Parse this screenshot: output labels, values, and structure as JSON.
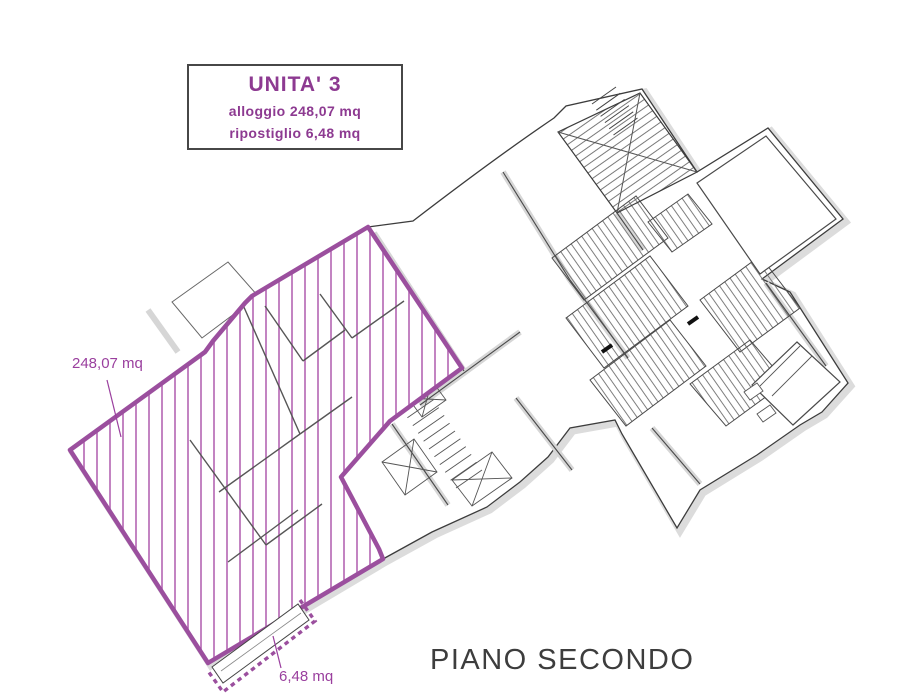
{
  "title_box": {
    "title": "UNITA' 3",
    "alloggio_line": "alloggio 248,07 mq",
    "ripostiglio_line": "ripostiglio 6,48 mq"
  },
  "annotations": {
    "alloggio_label": "248,07 mq",
    "ripostiglio_label": "6,48 mq"
  },
  "floor_title": "PIANO SECONDO",
  "colors": {
    "unit_boundary": "#9b4f9e",
    "unit_hatch": "#b466b2",
    "annotation_text": "#9a3f9e",
    "title_text": "#8d3a91",
    "building_wall": "#d9d9d9",
    "building_line": "#3c3c3c",
    "floor_title_text": "#3d3d3d"
  }
}
